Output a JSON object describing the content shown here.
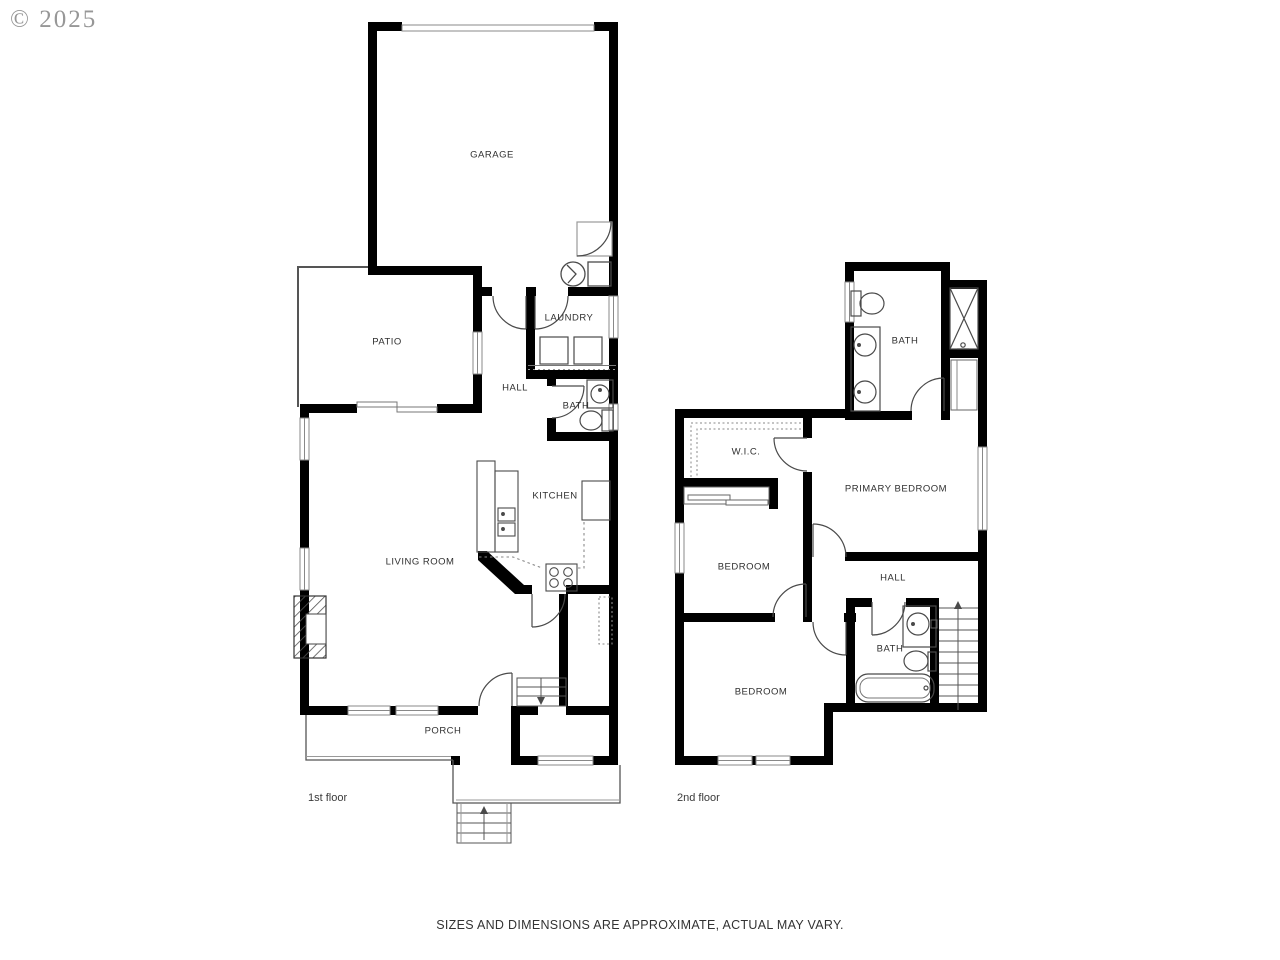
{
  "watermark": "© 2025",
  "footer": {
    "disclaimer": "SIZES AND DIMENSIONS ARE APPROXIMATE, ACTUAL MAY VARY."
  },
  "first_floor": {
    "caption": "1st floor",
    "rooms": {
      "garage": "GARAGE",
      "patio": "PATIO",
      "laundry": "LAUNDRY",
      "hall": "HALL",
      "bath": "BATH",
      "kitchen": "KITCHEN",
      "living_room": "LIVING ROOM",
      "porch": "PORCH"
    }
  },
  "second_floor": {
    "caption": "2nd floor",
    "rooms": {
      "bath_top": "BATH",
      "wic": "W.I.C.",
      "primary_bedroom": "PRIMARY BEDROOM",
      "bedroom_middle": "BEDROOM",
      "hall": "HALL",
      "bath_hall": "BATH",
      "bedroom_lower": "BEDROOM"
    }
  },
  "colors": {
    "walls": "#000000",
    "thin_lines": "#555555",
    "fixtures": "#4a4a4a",
    "labels": "#303030",
    "watermark": "#979797"
  }
}
